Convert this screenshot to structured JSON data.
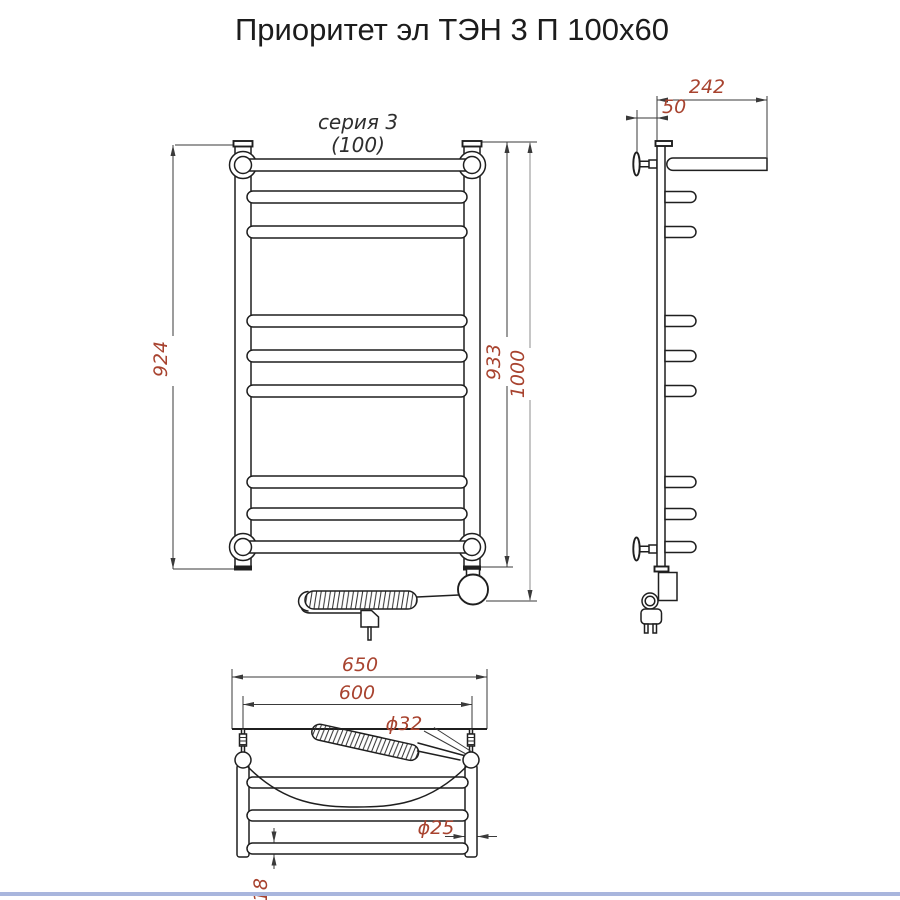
{
  "title": "Приоритет эл ТЭН 3 П 100х60",
  "front_view": {
    "series_label": "серия 3",
    "size_label": "(100)",
    "dims": {
      "mount_height": "924",
      "body_height": "933",
      "overall_height": "1000"
    }
  },
  "side_view": {
    "dims": {
      "depth": "242",
      "wall_offset": "50"
    }
  },
  "top_view": {
    "dims": {
      "overall_width": "650",
      "mount_width": "600",
      "heater_diameter": "ϕ32",
      "post_diameter": "ϕ25",
      "rung_diameter": "ϕ18"
    }
  },
  "colors": {
    "line": "#1f1f1f",
    "dim_line": "#3a3a3a",
    "dim_line_light": "#8d8d8d",
    "dim_text": "#a8432f",
    "title_text": "#1c1c1c",
    "footer_rule": "#a9b6dd"
  }
}
